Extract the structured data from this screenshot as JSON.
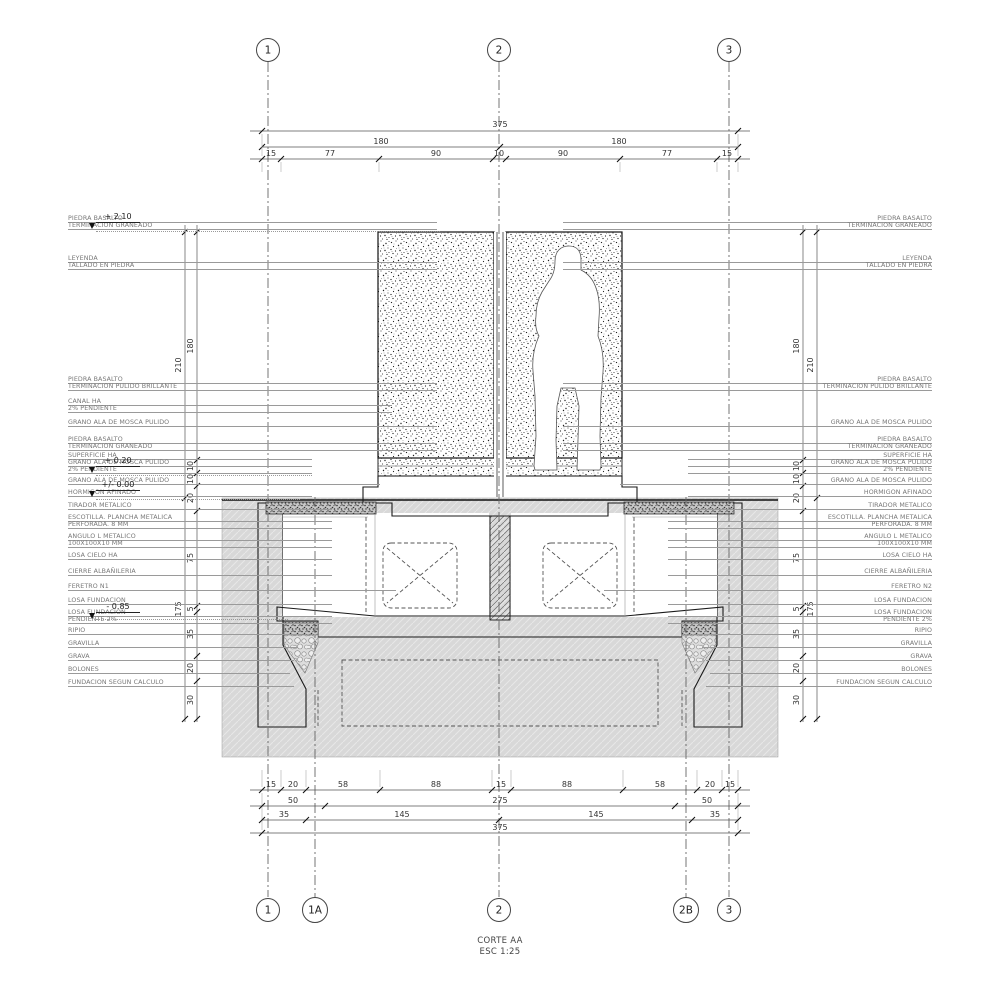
{
  "title": {
    "drawing": "CORTE AA",
    "scale": "ESC 1:25"
  },
  "grid": {
    "top": [
      "1",
      "2",
      "3"
    ],
    "bottom": [
      "1",
      "1A",
      "2",
      "2B",
      "3"
    ]
  },
  "elevations": [
    "+ 2.10",
    "+ 0.20",
    "+/- 0.00",
    "- 0.85"
  ],
  "dims": {
    "top_total": "375",
    "top_halves": [
      "180",
      "180"
    ],
    "top_segments": [
      "15",
      "77",
      "90",
      "10",
      "90",
      "77",
      "15"
    ],
    "bottom_row1": [
      "15",
      "20",
      "58",
      "88",
      "15",
      "88",
      "58",
      "20",
      "15"
    ],
    "bottom_row2": [
      "50",
      "275",
      "50"
    ],
    "bottom_row3": [
      "35",
      "145",
      "145",
      "35"
    ],
    "bottom_total": "375",
    "vertical_inner": [
      "180",
      "10",
      "10",
      "20",
      "75",
      "5",
      "35",
      "20",
      "30"
    ],
    "vertical_outer": [
      "210",
      "175"
    ]
  },
  "labels": {
    "left": [
      [
        "PIEDRA BASALTO",
        "TERMINACION GRANEADO"
      ],
      [
        "LEYENDA",
        "TALLADO EN PIEDRA"
      ],
      [
        "PIEDRA BASALTO",
        "TERMINACION PULIDO BRILLANTE"
      ],
      [
        "CANAL HA",
        "2% PENDIENTE"
      ],
      [
        "GRANO ALA DE MOSCA PULIDO"
      ],
      [
        "PIEDRA BASALTO",
        "TERMINACION GRANEADO"
      ],
      [
        "SUPERFICIE HA",
        "GRANO ALA DE MOSCA PULIDO",
        "2% PENDIENTE"
      ],
      [
        "GRANO ALA DE MOSCA PULIDO"
      ],
      [
        "HORMIGON AFINADO"
      ],
      [
        "TIRADOR METALICO"
      ],
      [
        "ESCOTILLA. PLANCHA METALICA",
        "PERFORADA. 8 MM"
      ],
      [
        "ANGULO L METALICO",
        "100X100X10 MM"
      ],
      [
        "LOSA CIELO HA"
      ],
      [
        "CIERRE ALBAÑILERIA"
      ],
      [
        "FERETRO N1"
      ],
      [
        "LOSA FUNDACION"
      ],
      [
        "LOSA FUNDACION",
        "PENDIENTE 2%"
      ],
      [
        "RIPIO"
      ],
      [
        "GRAVILLA"
      ],
      [
        "GRAVA"
      ],
      [
        "BOLONES"
      ],
      [
        "FUNDACION SEGUN CALCULO"
      ]
    ],
    "right": [
      [
        "PIEDRA BASALTO",
        "TERMINACION GRANEADO"
      ],
      [
        "LEYENDA",
        "TALLADO EN PIEDRA"
      ],
      [
        "PIEDRA BASALTO",
        "TERMINACION PULIDO BRILLANTE"
      ],
      [
        "GRANO ALA DE MOSCA PULIDO"
      ],
      [
        "PIEDRA BASALTO",
        "TERMINACION GRANEADO"
      ],
      [
        "SUPERFICIE HA",
        "GRANO ALA DE MOSCA PULIDO",
        "2% PENDIENTE"
      ],
      [
        "GRANO ALA DE MOSCA PULIDO"
      ],
      [
        "HORMIGON AFINADO"
      ],
      [
        "TIRADOR METALICO"
      ],
      [
        "ESCOTILLA. PLANCHA METALICA",
        "PERFORADA. 8 MM"
      ],
      [
        "ANGULO L METALICO",
        "100X100X10 MM"
      ],
      [
        "LOSA CIELO HA"
      ],
      [
        "CIERRE ALBAÑILERIA"
      ],
      [
        "FERETRO N2"
      ],
      [
        "LOSA FUNDACION"
      ],
      [
        "LOSA FUNDACION",
        "PENDIENTE 2%"
      ],
      [
        "RIPIO"
      ],
      [
        "GRAVILLA"
      ],
      [
        "GRAVA"
      ],
      [
        "BOLONES"
      ],
      [
        "FUNDACION SEGUN CALCULO"
      ]
    ]
  }
}
